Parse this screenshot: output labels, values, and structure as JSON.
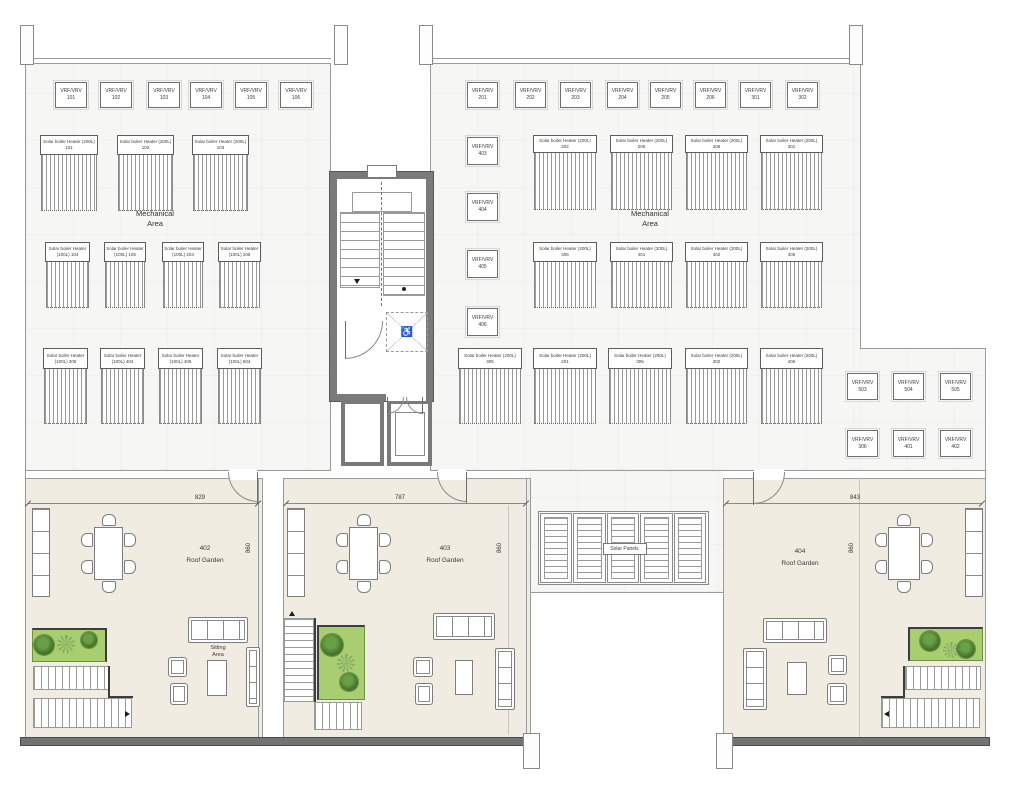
{
  "colors": {
    "mech_floor": "#f6f6f4",
    "garden_floor": "#f1ece2",
    "planter_green": "#a9ce70",
    "core_wall": "#7a7a7a",
    "parapet": "#737373"
  },
  "vrf_label": "VRF/VRV",
  "vrf_units": [
    {
      "x": 55,
      "y": 82,
      "w": 32,
      "h": 26,
      "id": "101"
    },
    {
      "x": 100,
      "y": 82,
      "w": 32,
      "h": 26,
      "id": "102"
    },
    {
      "x": 148,
      "y": 82,
      "w": 32,
      "h": 26,
      "id": "103"
    },
    {
      "x": 190,
      "y": 82,
      "w": 32,
      "h": 26,
      "id": "104"
    },
    {
      "x": 235,
      "y": 82,
      "w": 32,
      "h": 26,
      "id": "105"
    },
    {
      "x": 280,
      "y": 82,
      "w": 32,
      "h": 26,
      "id": "106"
    },
    {
      "x": 467,
      "y": 82,
      "w": 31,
      "h": 26,
      "id": "201"
    },
    {
      "x": 515,
      "y": 82,
      "w": 31,
      "h": 26,
      "id": "202"
    },
    {
      "x": 560,
      "y": 82,
      "w": 31,
      "h": 26,
      "id": "203"
    },
    {
      "x": 607,
      "y": 82,
      "w": 31,
      "h": 26,
      "id": "204"
    },
    {
      "x": 650,
      "y": 82,
      "w": 31,
      "h": 26,
      "id": "205"
    },
    {
      "x": 695,
      "y": 82,
      "w": 31,
      "h": 26,
      "id": "206"
    },
    {
      "x": 740,
      "y": 82,
      "w": 31,
      "h": 26,
      "id": "301"
    },
    {
      "x": 787,
      "y": 82,
      "w": 31,
      "h": 26,
      "id": "302"
    },
    {
      "x": 467,
      "y": 137,
      "w": 31,
      "h": 28,
      "id": "403"
    },
    {
      "x": 467,
      "y": 193,
      "w": 31,
      "h": 28,
      "id": "404"
    },
    {
      "x": 467,
      "y": 250,
      "w": 31,
      "h": 28,
      "id": "405"
    },
    {
      "x": 467,
      "y": 308,
      "w": 31,
      "h": 28,
      "id": "406"
    },
    {
      "x": 847,
      "y": 373,
      "w": 31,
      "h": 27,
      "id": "503"
    },
    {
      "x": 893,
      "y": 373,
      "w": 31,
      "h": 27,
      "id": "504"
    },
    {
      "x": 940,
      "y": 373,
      "w": 31,
      "h": 27,
      "id": "505"
    },
    {
      "x": 847,
      "y": 430,
      "w": 31,
      "h": 27,
      "id": "306"
    },
    {
      "x": 893,
      "y": 430,
      "w": 31,
      "h": 27,
      "id": "401"
    },
    {
      "x": 940,
      "y": 430,
      "w": 31,
      "h": 27,
      "id": "402"
    }
  ],
  "heaters": [
    {
      "x": 40,
      "y": 135,
      "w": 58,
      "lh": 20,
      "hh": 56,
      "name": "Solar boiler Heater (200L)",
      "id": "101"
    },
    {
      "x": 117,
      "y": 135,
      "w": 57,
      "lh": 20,
      "hh": 56,
      "name": "Solar boiler Heater (200L)",
      "id": "102"
    },
    {
      "x": 192,
      "y": 135,
      "w": 57,
      "lh": 20,
      "hh": 56,
      "name": "Solar boiler Heater (200L)",
      "id": "103"
    },
    {
      "x": 45,
      "y": 242,
      "w": 45,
      "lh": 20,
      "hh": 46,
      "name": "Solar boiler Heater",
      "id": "(100L) 104"
    },
    {
      "x": 104,
      "y": 242,
      "w": 42,
      "lh": 20,
      "hh": 46,
      "name": "Solar boiler Heater",
      "id": "(100L) 105"
    },
    {
      "x": 162,
      "y": 242,
      "w": 42,
      "lh": 20,
      "hh": 46,
      "name": "Solar boiler Heater",
      "id": "(100L) 204"
    },
    {
      "x": 218,
      "y": 242,
      "w": 43,
      "lh": 20,
      "hh": 46,
      "name": "Solar boiler Heater",
      "id": "(100L) 205"
    },
    {
      "x": 43,
      "y": 348,
      "w": 45,
      "lh": 21,
      "hh": 55,
      "name": "Solar boiler Heater",
      "id": "(100L) 305"
    },
    {
      "x": 100,
      "y": 348,
      "w": 45,
      "lh": 21,
      "hh": 55,
      "name": "Solar boiler Heater",
      "id": "(100L) 404"
    },
    {
      "x": 158,
      "y": 348,
      "w": 45,
      "lh": 21,
      "hh": 55,
      "name": "Solar boiler Heater",
      "id": "(100L) 405"
    },
    {
      "x": 217,
      "y": 348,
      "w": 45,
      "lh": 21,
      "hh": 55,
      "name": "Solar boiler Heater",
      "id": "(100L) 504"
    },
    {
      "x": 533,
      "y": 135,
      "w": 64,
      "lh": 18,
      "hh": 57,
      "name": "Solar boiler Heater (200L)",
      "id": "202"
    },
    {
      "x": 610,
      "y": 135,
      "w": 63,
      "lh": 18,
      "hh": 57,
      "name": "Solar boiler Heater (200L)",
      "id": "205"
    },
    {
      "x": 685,
      "y": 135,
      "w": 63,
      "lh": 18,
      "hh": 57,
      "name": "Solar boiler Heater (200L)",
      "id": "206"
    },
    {
      "x": 760,
      "y": 135,
      "w": 63,
      "lh": 18,
      "hh": 57,
      "name": "Solar boiler Heater (200L)",
      "id": "301"
    },
    {
      "x": 533,
      "y": 242,
      "w": 64,
      "lh": 20,
      "hh": 46,
      "name": "Solar boiler Heater (200L)",
      "id": "306"
    },
    {
      "x": 610,
      "y": 242,
      "w": 63,
      "lh": 20,
      "hh": 46,
      "name": "Solar boiler Heater (200L)",
      "id": "401"
    },
    {
      "x": 685,
      "y": 242,
      "w": 63,
      "lh": 20,
      "hh": 46,
      "name": "Solar boiler Heater (200L)",
      "id": "402"
    },
    {
      "x": 760,
      "y": 242,
      "w": 63,
      "lh": 20,
      "hh": 46,
      "name": "Solar boiler Heater (200L)",
      "id": "405"
    },
    {
      "x": 458,
      "y": 348,
      "w": 64,
      "lh": 21,
      "hh": 55,
      "name": "Solar boiler Heater (200L)",
      "id": "305"
    },
    {
      "x": 533,
      "y": 348,
      "w": 64,
      "lh": 21,
      "hh": 55,
      "name": "Solar boiler Heater (200L)",
      "id": "201"
    },
    {
      "x": 608,
      "y": 348,
      "w": 64,
      "lh": 21,
      "hh": 55,
      "name": "Solar boiler Heater (200L)",
      "id": "306"
    },
    {
      "x": 685,
      "y": 348,
      "w": 63,
      "lh": 21,
      "hh": 55,
      "name": "Solar boiler Heater (200L)",
      "id": "302"
    },
    {
      "x": 760,
      "y": 348,
      "w": 63,
      "lh": 21,
      "hh": 55,
      "name": "Solar boiler Heater (200L)",
      "id": "406"
    }
  ],
  "mech_labels": [
    {
      "x": 155,
      "y": 209,
      "text": "Mechanical\nArea"
    },
    {
      "x": 650,
      "y": 209,
      "text": "Mechanical\nArea"
    }
  ],
  "core": {
    "accessibility_icon": "♿"
  },
  "solar": {
    "x": 540,
    "y": 513,
    "w": 167,
    "h": 70,
    "panels": 5,
    "label": "Solar Panels"
  },
  "gardens": [
    {
      "id": "402",
      "name": "Roof Garden",
      "dim_top": "829",
      "dim_side": "860",
      "floor": {
        "x": 25,
        "y": 478,
        "w": 237,
        "h": 259
      },
      "dim_line": {
        "x1": 28,
        "x2": 258,
        "y": 503,
        "label_x": 200
      },
      "dim_side_pos": {
        "x": 249,
        "y": 548
      },
      "label_pos": {
        "x": 205,
        "y": 543
      },
      "table": {
        "x": 94,
        "y": 527,
        "w": 29,
        "h": 53
      },
      "bench": {
        "x": 32,
        "y": 508,
        "w": 18,
        "h": 89
      },
      "planter": {
        "x": 32,
        "y": 628,
        "w": 75,
        "h": 34,
        "dark": "tr",
        "trees": [
          {
            "cx": 44,
            "cy": 645,
            "r": 10,
            "t": "dense"
          },
          {
            "cx": 66,
            "cy": 644,
            "r": 9,
            "t": "sparse"
          },
          {
            "cx": 89,
            "cy": 640,
            "r": 8,
            "t": "dense"
          }
        ]
      },
      "stairs": [
        {
          "type": "h",
          "x": 33,
          "y": 666,
          "w": 76,
          "h": 24
        },
        {
          "type": "h",
          "x": 33,
          "y": 698,
          "w": 99,
          "h": 30
        }
      ],
      "stair_dark": [
        {
          "x": 108,
          "y": 666,
          "w": 2,
          "h": 32
        },
        {
          "x": 108,
          "y": 696,
          "w": 25,
          "h": 2
        }
      ],
      "stair_arrow": {
        "x": 125,
        "y": 711,
        "dir": "r"
      },
      "sitting": {
        "text": "Sitting\nArea",
        "x": 218,
        "y": 645
      },
      "sofas": [
        {
          "t": "sofa-h",
          "x": 188,
          "y": 617,
          "w": 60,
          "h": 26
        },
        {
          "t": "arm",
          "x": 168,
          "y": 657,
          "w": 19,
          "h": 20
        },
        {
          "t": "arm",
          "x": 170,
          "y": 683,
          "w": 18,
          "h": 22
        },
        {
          "t": "ctable",
          "x": 207,
          "y": 660,
          "w": 20,
          "h": 36
        },
        {
          "t": "sofa-v",
          "x": 246,
          "y": 647,
          "w": 14,
          "h": 60
        }
      ],
      "door": {
        "x": 228,
        "y": 472,
        "r": 30,
        "hinge": "tr"
      }
    },
    {
      "id": "403",
      "name": "Roof Garden",
      "dim_top": "787",
      "dim_side": "860",
      "floor": {
        "x": 283,
        "y": 478,
        "w": 247,
        "h": 259
      },
      "dim_line": {
        "x1": 286,
        "x2": 526,
        "y": 503,
        "label_x": 400
      },
      "dim_side_pos": {
        "x": 500,
        "y": 548
      },
      "label_pos": {
        "x": 445,
        "y": 543
      },
      "table": {
        "x": 349,
        "y": 527,
        "w": 29,
        "h": 53
      },
      "bench": {
        "x": 287,
        "y": 508,
        "w": 18,
        "h": 89
      },
      "planter": {
        "x": 317,
        "y": 625,
        "w": 48,
        "h": 75,
        "dark": "tl",
        "trees": [
          {
            "cx": 332,
            "cy": 645,
            "r": 11,
            "t": "dense"
          },
          {
            "cx": 346,
            "cy": 663,
            "r": 9,
            "t": "sparse"
          },
          {
            "cx": 349,
            "cy": 682,
            "r": 9,
            "t": "dense"
          }
        ]
      },
      "stairs": [
        {
          "type": "v",
          "x": 284,
          "y": 618,
          "w": 30,
          "h": 84
        },
        {
          "type": "h",
          "x": 314,
          "y": 702,
          "w": 48,
          "h": 28
        }
      ],
      "stair_dark": [
        {
          "x": 314,
          "y": 618,
          "w": 2,
          "h": 84
        }
      ],
      "stair_arrow": {
        "x": 289,
        "y": 611,
        "dir": "u"
      },
      "sofas": [
        {
          "t": "sofa-h",
          "x": 433,
          "y": 613,
          "w": 62,
          "h": 27
        },
        {
          "t": "arm",
          "x": 413,
          "y": 657,
          "w": 20,
          "h": 20
        },
        {
          "t": "arm",
          "x": 415,
          "y": 683,
          "w": 18,
          "h": 22
        },
        {
          "t": "ctable",
          "x": 455,
          "y": 660,
          "w": 18,
          "h": 35
        },
        {
          "t": "sofa-v",
          "x": 495,
          "y": 648,
          "w": 20,
          "h": 62
        }
      ],
      "door": {
        "x": 437,
        "y": 472,
        "r": 30,
        "hinge": "tr"
      }
    },
    {
      "id": "404",
      "name": "Roof Garden",
      "dim_top": "843",
      "dim_side": "860",
      "floor": {
        "x": 723,
        "y": 478,
        "w": 262,
        "h": 259
      },
      "dim_line": {
        "x1": 726,
        "x2": 982,
        "y": 503,
        "label_x": 855
      },
      "dim_side_pos": {
        "x": 852,
        "y": 548
      },
      "label_pos": {
        "x": 800,
        "y": 546
      },
      "table": {
        "x": 888,
        "y": 527,
        "w": 32,
        "h": 53
      },
      "bench": {
        "x": 965,
        "y": 508,
        "w": 18,
        "h": 89
      },
      "planter": {
        "x": 908,
        "y": 627,
        "w": 75,
        "h": 34,
        "dark": "tl",
        "trees": [
          {
            "cx": 930,
            "cy": 641,
            "r": 10,
            "t": "dense"
          },
          {
            "cx": 951,
            "cy": 650,
            "r": 8,
            "t": "sparse"
          },
          {
            "cx": 966,
            "cy": 649,
            "r": 9,
            "t": "dense"
          }
        ]
      },
      "stairs": [
        {
          "type": "h",
          "x": 905,
          "y": 666,
          "w": 76,
          "h": 24
        },
        {
          "type": "h",
          "x": 881,
          "y": 698,
          "w": 99,
          "h": 30
        }
      ],
      "stair_dark": [
        {
          "x": 903,
          "y": 666,
          "w": 2,
          "h": 32
        },
        {
          "x": 881,
          "y": 696,
          "w": 24,
          "h": 2
        }
      ],
      "stair_arrow": {
        "x": 884,
        "y": 711,
        "dir": "l"
      },
      "sofas": [
        {
          "t": "sofa-h",
          "x": 763,
          "y": 618,
          "w": 64,
          "h": 25
        },
        {
          "t": "sofa-v",
          "x": 743,
          "y": 648,
          "w": 24,
          "h": 62
        },
        {
          "t": "ctable",
          "x": 787,
          "y": 662,
          "w": 20,
          "h": 33
        },
        {
          "t": "arm",
          "x": 828,
          "y": 655,
          "w": 19,
          "h": 20
        },
        {
          "t": "arm",
          "x": 827,
          "y": 683,
          "w": 20,
          "h": 22
        }
      ],
      "door": {
        "x": 753,
        "y": 472,
        "r": 32,
        "hinge": "tl"
      }
    }
  ],
  "layout": {
    "floors": [
      {
        "x": 26,
        "y": 63,
        "w": 304,
        "h": 407
      },
      {
        "x": 430,
        "y": 63,
        "w": 431,
        "h": 407
      },
      {
        "x": 860,
        "y": 348,
        "w": 125,
        "h": 122
      },
      {
        "x": 530,
        "y": 470,
        "w": 193,
        "h": 122
      }
    ],
    "walls": [
      {
        "x": 25,
        "y": 58,
        "w": 1,
        "h": 680
      },
      {
        "x": 26,
        "y": 58,
        "w": 305,
        "h": 1
      },
      {
        "x": 26,
        "y": 63,
        "w": 305,
        "h": 1
      },
      {
        "x": 425,
        "y": 58,
        "w": 436,
        "h": 1
      },
      {
        "x": 425,
        "y": 63,
        "w": 436,
        "h": 1
      },
      {
        "x": 330,
        "y": 63,
        "w": 1,
        "h": 110
      },
      {
        "x": 330,
        "y": 399,
        "w": 1,
        "h": 72
      },
      {
        "x": 430,
        "y": 63,
        "w": 1,
        "h": 110
      },
      {
        "x": 430,
        "y": 399,
        "w": 1,
        "h": 72
      },
      {
        "x": 860,
        "y": 63,
        "w": 1,
        "h": 286
      },
      {
        "x": 860,
        "y": 348,
        "w": 126,
        "h": 1
      },
      {
        "x": 985,
        "y": 348,
        "w": 1,
        "h": 390
      },
      {
        "x": 26,
        "y": 470,
        "w": 305,
        "h": 1
      },
      {
        "x": 430,
        "y": 470,
        "w": 556,
        "h": 1
      },
      {
        "x": 25,
        "y": 478,
        "w": 237,
        "h": 1
      },
      {
        "x": 283,
        "y": 478,
        "w": 247,
        "h": 1
      },
      {
        "x": 723,
        "y": 478,
        "w": 262,
        "h": 1
      },
      {
        "x": 258,
        "y": 478,
        "w": 1,
        "h": 260
      },
      {
        "x": 262,
        "y": 478,
        "w": 1,
        "h": 260
      },
      {
        "x": 283,
        "y": 478,
        "w": 1,
        "h": 260
      },
      {
        "x": 526,
        "y": 478,
        "w": 1,
        "h": 260
      },
      {
        "x": 530,
        "y": 478,
        "w": 1,
        "h": 260
      },
      {
        "x": 723,
        "y": 478,
        "w": 1,
        "h": 260
      },
      {
        "x": 530,
        "y": 592,
        "w": 193,
        "h": 1
      },
      {
        "x": 508,
        "y": 505,
        "w": 1,
        "h": 230,
        "t": "dim"
      },
      {
        "x": 859,
        "y": 478,
        "w": 1,
        "h": 259,
        "t": "dim"
      }
    ],
    "parapets": [
      {
        "x": 20,
        "y": 737,
        "w": 516,
        "h": 9
      },
      {
        "x": 717,
        "y": 737,
        "w": 273,
        "h": 9
      }
    ],
    "pilasters": [
      {
        "x": 20,
        "y": 25,
        "w": 12,
        "h": 38
      },
      {
        "x": 334,
        "y": 25,
        "w": 12,
        "h": 38
      },
      {
        "x": 419,
        "y": 25,
        "w": 12,
        "h": 38
      },
      {
        "x": 849,
        "y": 25,
        "w": 12,
        "h": 38
      }
    ],
    "piers": [
      {
        "x": 523,
        "y": 733,
        "w": 15,
        "h": 34
      },
      {
        "x": 716,
        "y": 733,
        "w": 15,
        "h": 34
      }
    ],
    "openings": [
      {
        "x": 229,
        "y": 469,
        "w": 28,
        "h": 11
      },
      {
        "x": 438,
        "y": 469,
        "w": 28,
        "h": 11
      },
      {
        "x": 754,
        "y": 469,
        "w": 30,
        "h": 11
      }
    ]
  }
}
